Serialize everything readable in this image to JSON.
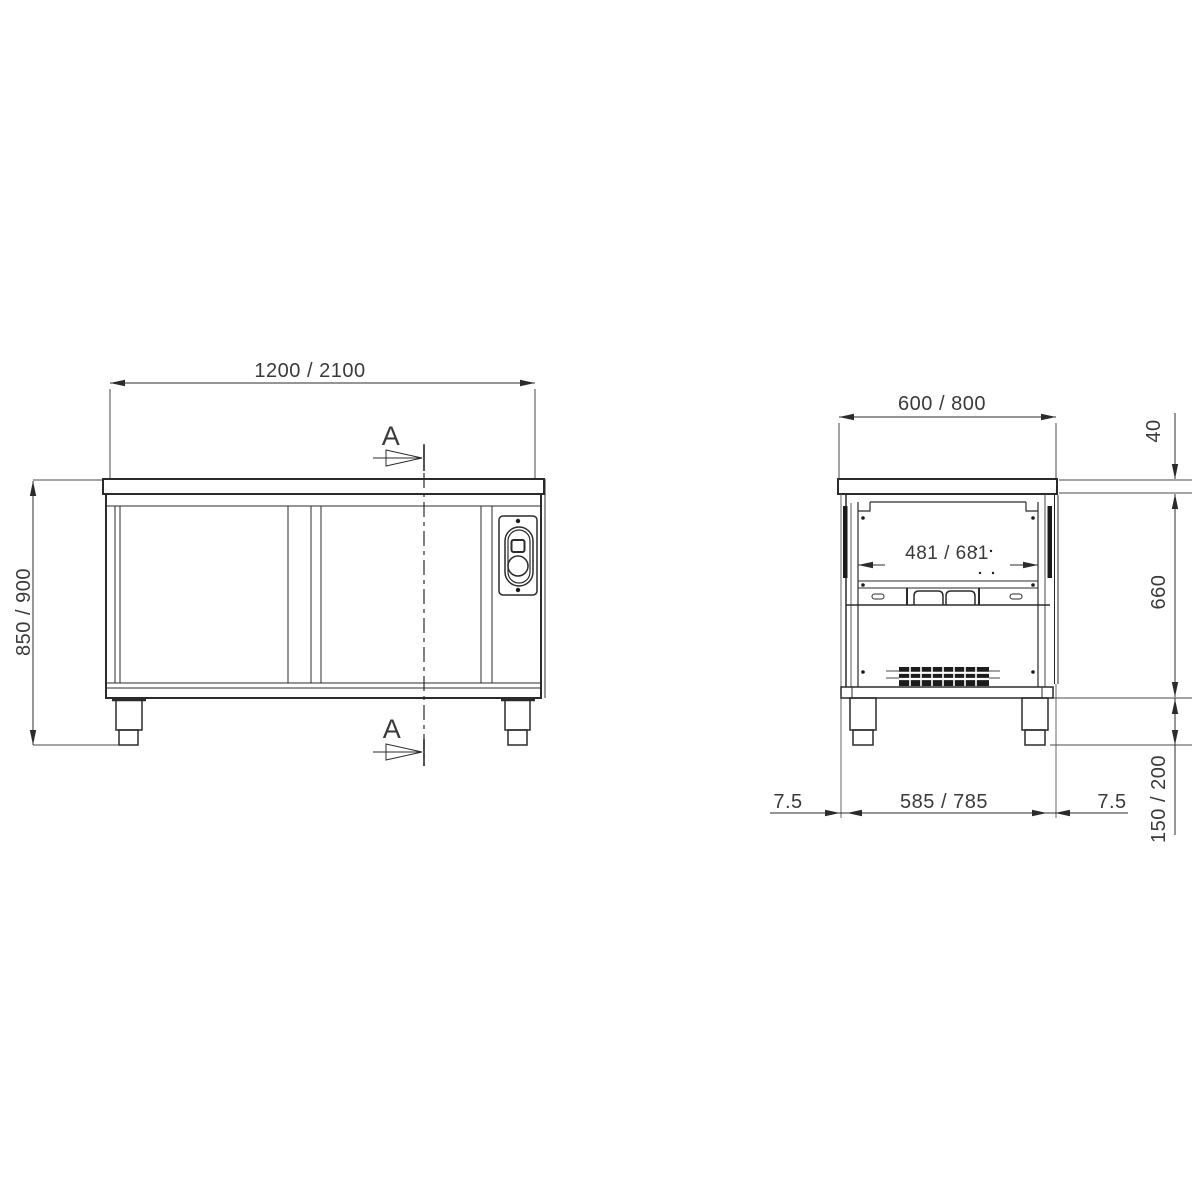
{
  "background": "#ffffff",
  "line_color": "#2b2b2b",
  "text_color": "#3a3a3a",
  "front_view": {
    "width_dim": "1200 / 2100",
    "height_dim": "850 / 900",
    "section_marker_top": "A",
    "section_marker_bottom": "A"
  },
  "side_view": {
    "depth_dim": "600 / 800",
    "worktop_thickness_dim": "40",
    "body_height_dim": "660",
    "interior_depth_dim": "481 / 681",
    "base_depth_dim": "585 / 785",
    "overhang_left_dim": "7.5",
    "overhang_right_dim": "7.5",
    "foot_height_dim": "150 / 200"
  }
}
